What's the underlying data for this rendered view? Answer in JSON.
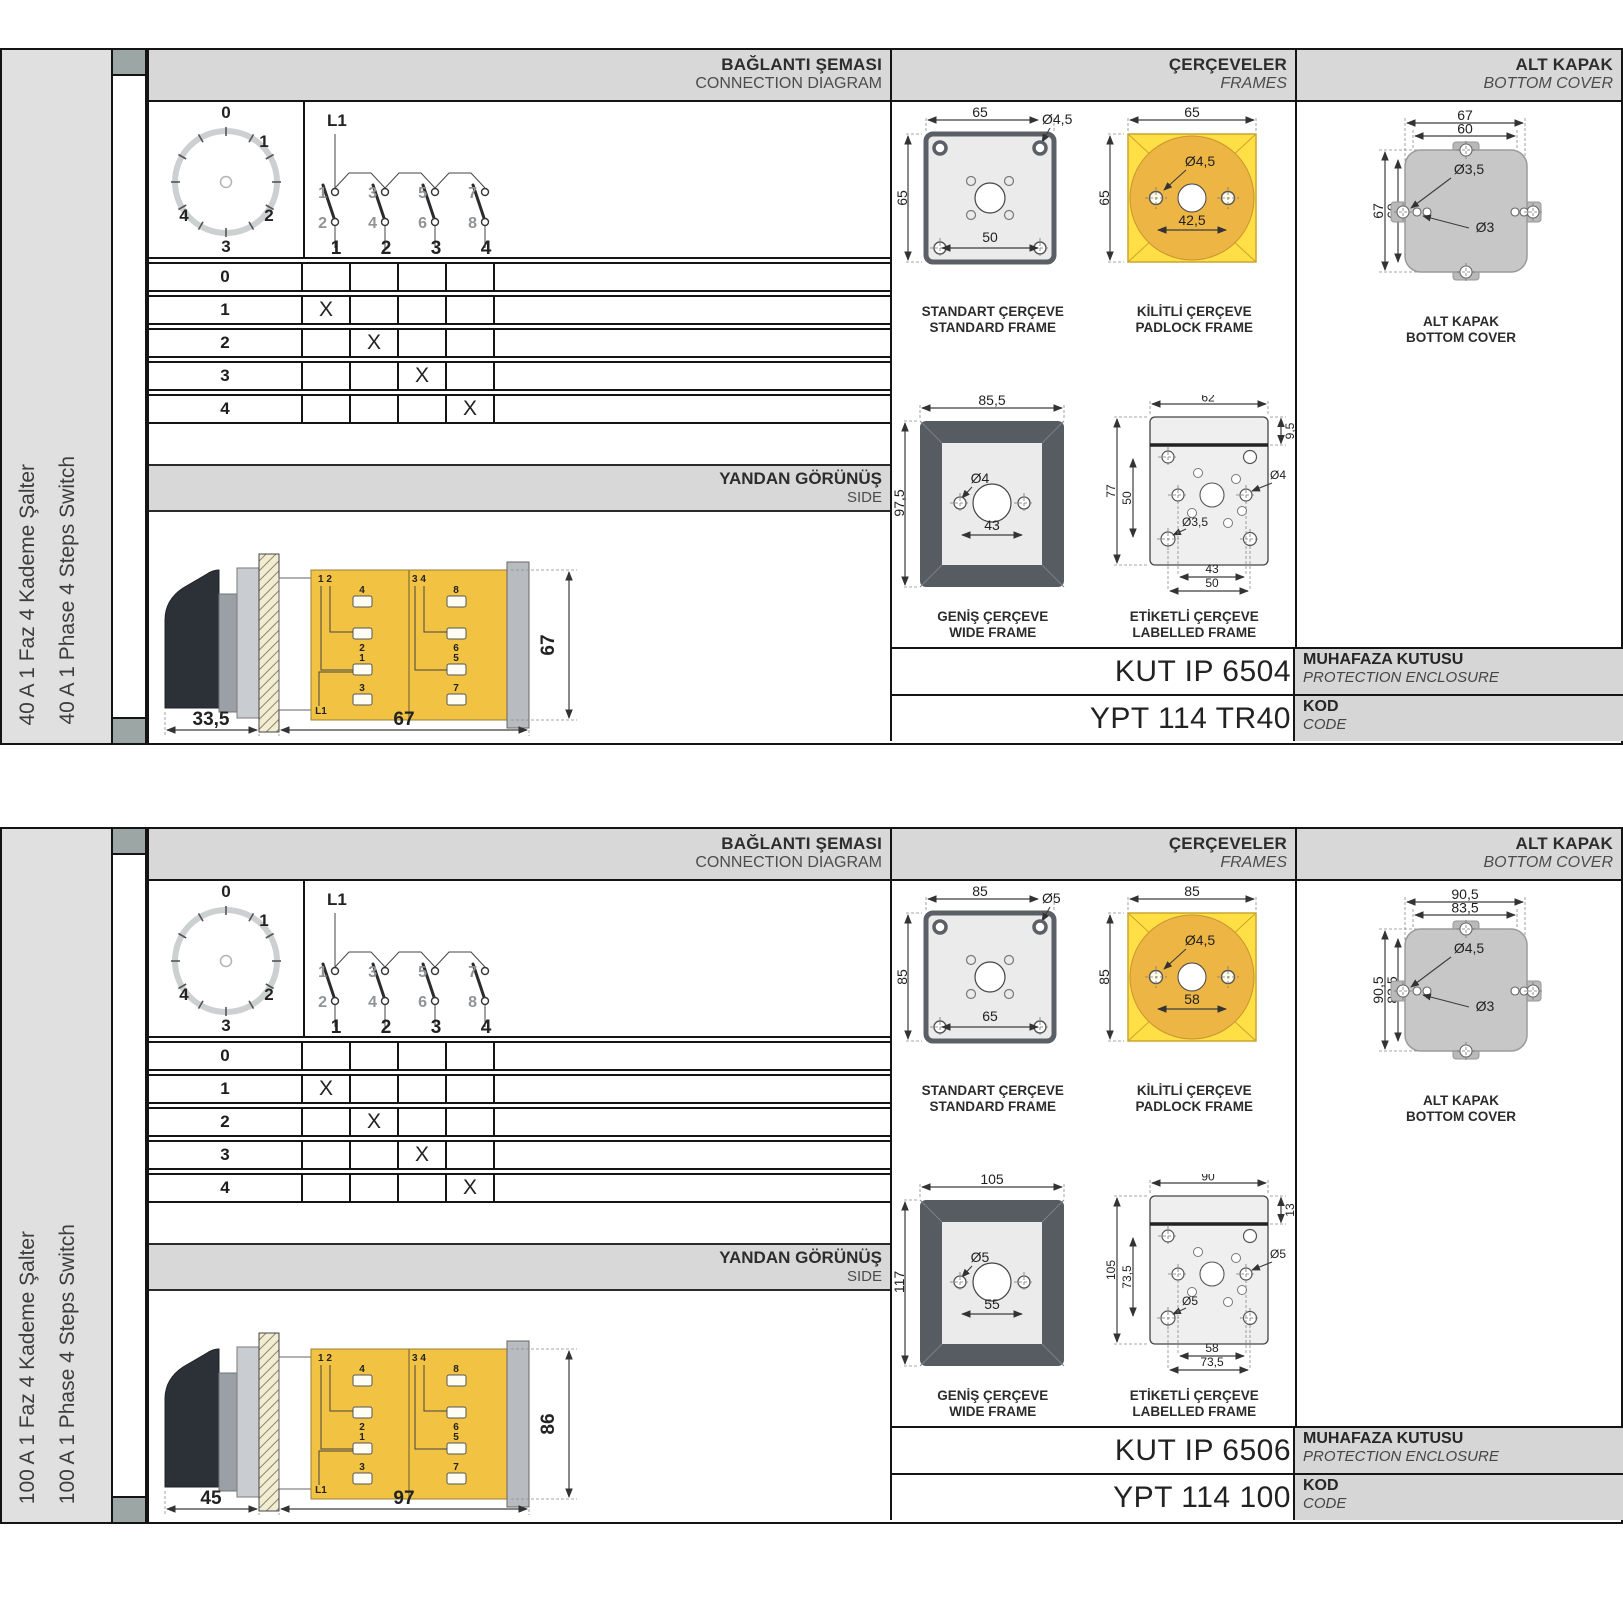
{
  "s0": {
    "product_tr": "40 A 1 Faz 4 Kademe Şalter",
    "product_en": "40 A 1 Phase 4 Steps Switch",
    "head": {
      "conn_tr": "BAĞLANTI ŞEMASI",
      "conn_en": "CONNECTION DIAGRAM",
      "frames_tr": "ÇERÇEVELER",
      "frames_en": "FRAMES",
      "cover_tr": "ALT KAPAK",
      "cover_en": "BOTTOM COVER"
    },
    "dial": {
      "p0": "0",
      "p1": "1",
      "p2": "2",
      "p3": "3",
      "p4": "4"
    },
    "contacts": {
      "feed": "L1",
      "u1": "1",
      "u2": "3",
      "u3": "5",
      "u4": "7",
      "d1": "2",
      "d2": "4",
      "d3": "6",
      "d4": "8",
      "o1": "1",
      "o2": "2",
      "o3": "3",
      "o4": "4"
    },
    "table": {
      "rows": [
        "0",
        "1",
        "2",
        "3",
        "4"
      ],
      "marks": [
        [
          "",
          "",
          "",
          ""
        ],
        [
          "X",
          "",
          "",
          ""
        ],
        [
          "",
          "X",
          "",
          ""
        ],
        [
          "",
          "",
          "X",
          ""
        ],
        [
          "",
          "",
          "",
          "X"
        ]
      ]
    },
    "side": {
      "tr": "YANDAN GÖRÜNÜŞ",
      "en": "SIDE",
      "dim_a": "33,5",
      "dim_b": "67",
      "dim_h": "67",
      "t12": "1 2",
      "t34": "3 4",
      "b4": "4",
      "b8": "8",
      "b2": "2",
      "b6": "6",
      "b1": "1",
      "b5": "5",
      "b3": "3",
      "b7": "7",
      "l1": "L1"
    },
    "standard": {
      "tr": "STANDART ÇERÇEVE",
      "en": "STANDARD FRAME",
      "w": "65",
      "h": "65",
      "hole": "Ø4,5",
      "pitch": "50"
    },
    "padlock": {
      "tr": "KİLİTLİ ÇERÇEVE",
      "en": "PADLOCK FRAME",
      "w": "65",
      "h": "65",
      "hole": "Ø4,5",
      "pitch": "42,5"
    },
    "wide": {
      "tr": "GENİŞ ÇERÇEVE",
      "en": "WIDE FRAME",
      "w": "85,5",
      "h": "97,5",
      "hole": "Ø4",
      "pitch": "43"
    },
    "labelled": {
      "tr": "ETİKETLİ ÇERÇEVE",
      "en": "LABELLED FRAME",
      "w": "62",
      "h": "77",
      "inner": "50",
      "top": "9,5",
      "hole_r": "Ø4",
      "hole_b": "Ø3,5",
      "pitch1": "43",
      "pitch2": "50"
    },
    "cover": {
      "tr": "ALT KAPAK",
      "en": "BOTTOM COVER",
      "w1": "67",
      "w2": "60",
      "h1": "67",
      "h2": "60",
      "hole1": "Ø3,5",
      "hole2": "Ø3"
    },
    "enclosure": {
      "value": "KUT IP 6504",
      "tr": "MUHAFAZA KUTUSU",
      "en": "PROTECTION ENCLOSURE"
    },
    "code": {
      "value": "YPT 114 TR40",
      "tr": "KOD",
      "en": "CODE"
    }
  },
  "s1": {
    "product_tr": "100 A 1 Faz 4 Kademe Şalter",
    "product_en": "100 A 1 Phase 4 Steps Switch",
    "head": {
      "conn_tr": "BAĞLANTI ŞEMASI",
      "conn_en": "CONNECTION DIAGRAM",
      "frames_tr": "ÇERÇEVELER",
      "frames_en": "FRAMES",
      "cover_tr": "ALT KAPAK",
      "cover_en": "BOTTOM COVER"
    },
    "dial": {
      "p0": "0",
      "p1": "1",
      "p2": "2",
      "p3": "3",
      "p4": "4"
    },
    "contacts": {
      "feed": "L1",
      "u1": "1",
      "u2": "3",
      "u3": "5",
      "u4": "7",
      "d1": "2",
      "d2": "4",
      "d3": "6",
      "d4": "8",
      "o1": "1",
      "o2": "2",
      "o3": "3",
      "o4": "4"
    },
    "table": {
      "rows": [
        "0",
        "1",
        "2",
        "3",
        "4"
      ],
      "marks": [
        [
          "",
          "",
          "",
          ""
        ],
        [
          "X",
          "",
          "",
          ""
        ],
        [
          "",
          "X",
          "",
          ""
        ],
        [
          "",
          "",
          "X",
          ""
        ],
        [
          "",
          "",
          "",
          "X"
        ]
      ]
    },
    "side": {
      "tr": "YANDAN GÖRÜNÜŞ",
      "en": "SIDE",
      "dim_a": "45",
      "dim_b": "97",
      "dim_h": "86",
      "t12": "1 2",
      "t34": "3 4",
      "b4": "4",
      "b8": "8",
      "b2": "2",
      "b6": "6",
      "b1": "1",
      "b5": "5",
      "b3": "3",
      "b7": "7",
      "l1": "L1"
    },
    "standard": {
      "tr": "STANDART ÇERÇEVE",
      "en": "STANDARD FRAME",
      "w": "85",
      "h": "85",
      "hole": "Ø5",
      "pitch": "65"
    },
    "padlock": {
      "tr": "KİLİTLİ ÇERÇEVE",
      "en": "PADLOCK FRAME",
      "w": "85",
      "h": "85",
      "hole": "Ø4,5",
      "pitch": "58"
    },
    "wide": {
      "tr": "GENİŞ ÇERÇEVE",
      "en": "WIDE FRAME",
      "w": "105",
      "h": "117",
      "hole": "Ø5",
      "pitch": "55"
    },
    "labelled": {
      "tr": "ETİKETLİ ÇERÇEVE",
      "en": "LABELLED FRAME",
      "w": "90",
      "h": "105",
      "inner": "73,5",
      "top": "13",
      "hole_r": "Ø5",
      "hole_b": "Ø5",
      "pitch1": "58",
      "pitch2": "73,5"
    },
    "cover": {
      "tr": "ALT KAPAK",
      "en": "BOTTOM COVER",
      "w1": "90,5",
      "w2": "83,5",
      "h1": "90,5",
      "h2": "83,5",
      "hole1": "Ø4,5",
      "hole2": "Ø3"
    },
    "enclosure": {
      "value": "KUT IP 6506",
      "tr": "MUHAFAZA KUTUSU",
      "en": "PROTECTION ENCLOSURE"
    },
    "code": {
      "value": "YPT 114 100",
      "tr": "KOD",
      "en": "CODE"
    }
  }
}
